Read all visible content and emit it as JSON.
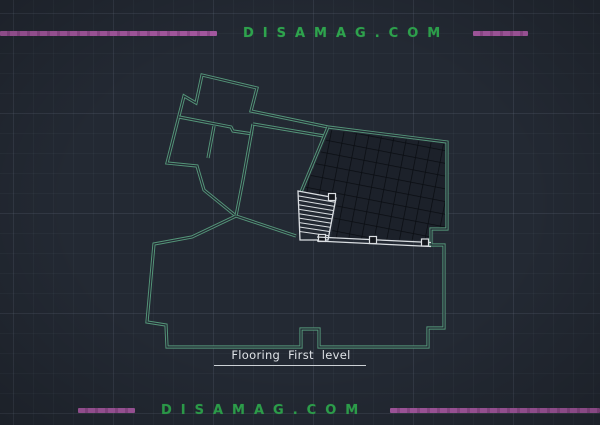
{
  "watermarks": {
    "top": "DISAMAG.COM",
    "bottom": "DISAMAG.COM"
  },
  "drawing": {
    "caption": "Flooring First level"
  },
  "colors": {
    "background": "#232933",
    "wall_green": "#55977a",
    "accent_green": "#2ea44d",
    "accent_purple": "#a558a0",
    "accent_purple_dark": "#8f4a8b",
    "drawing_white": "#d9dde1",
    "tile_fill": "#1c212a",
    "tile_line": "#0a0d12",
    "caption_white": "#dfe3e7"
  }
}
